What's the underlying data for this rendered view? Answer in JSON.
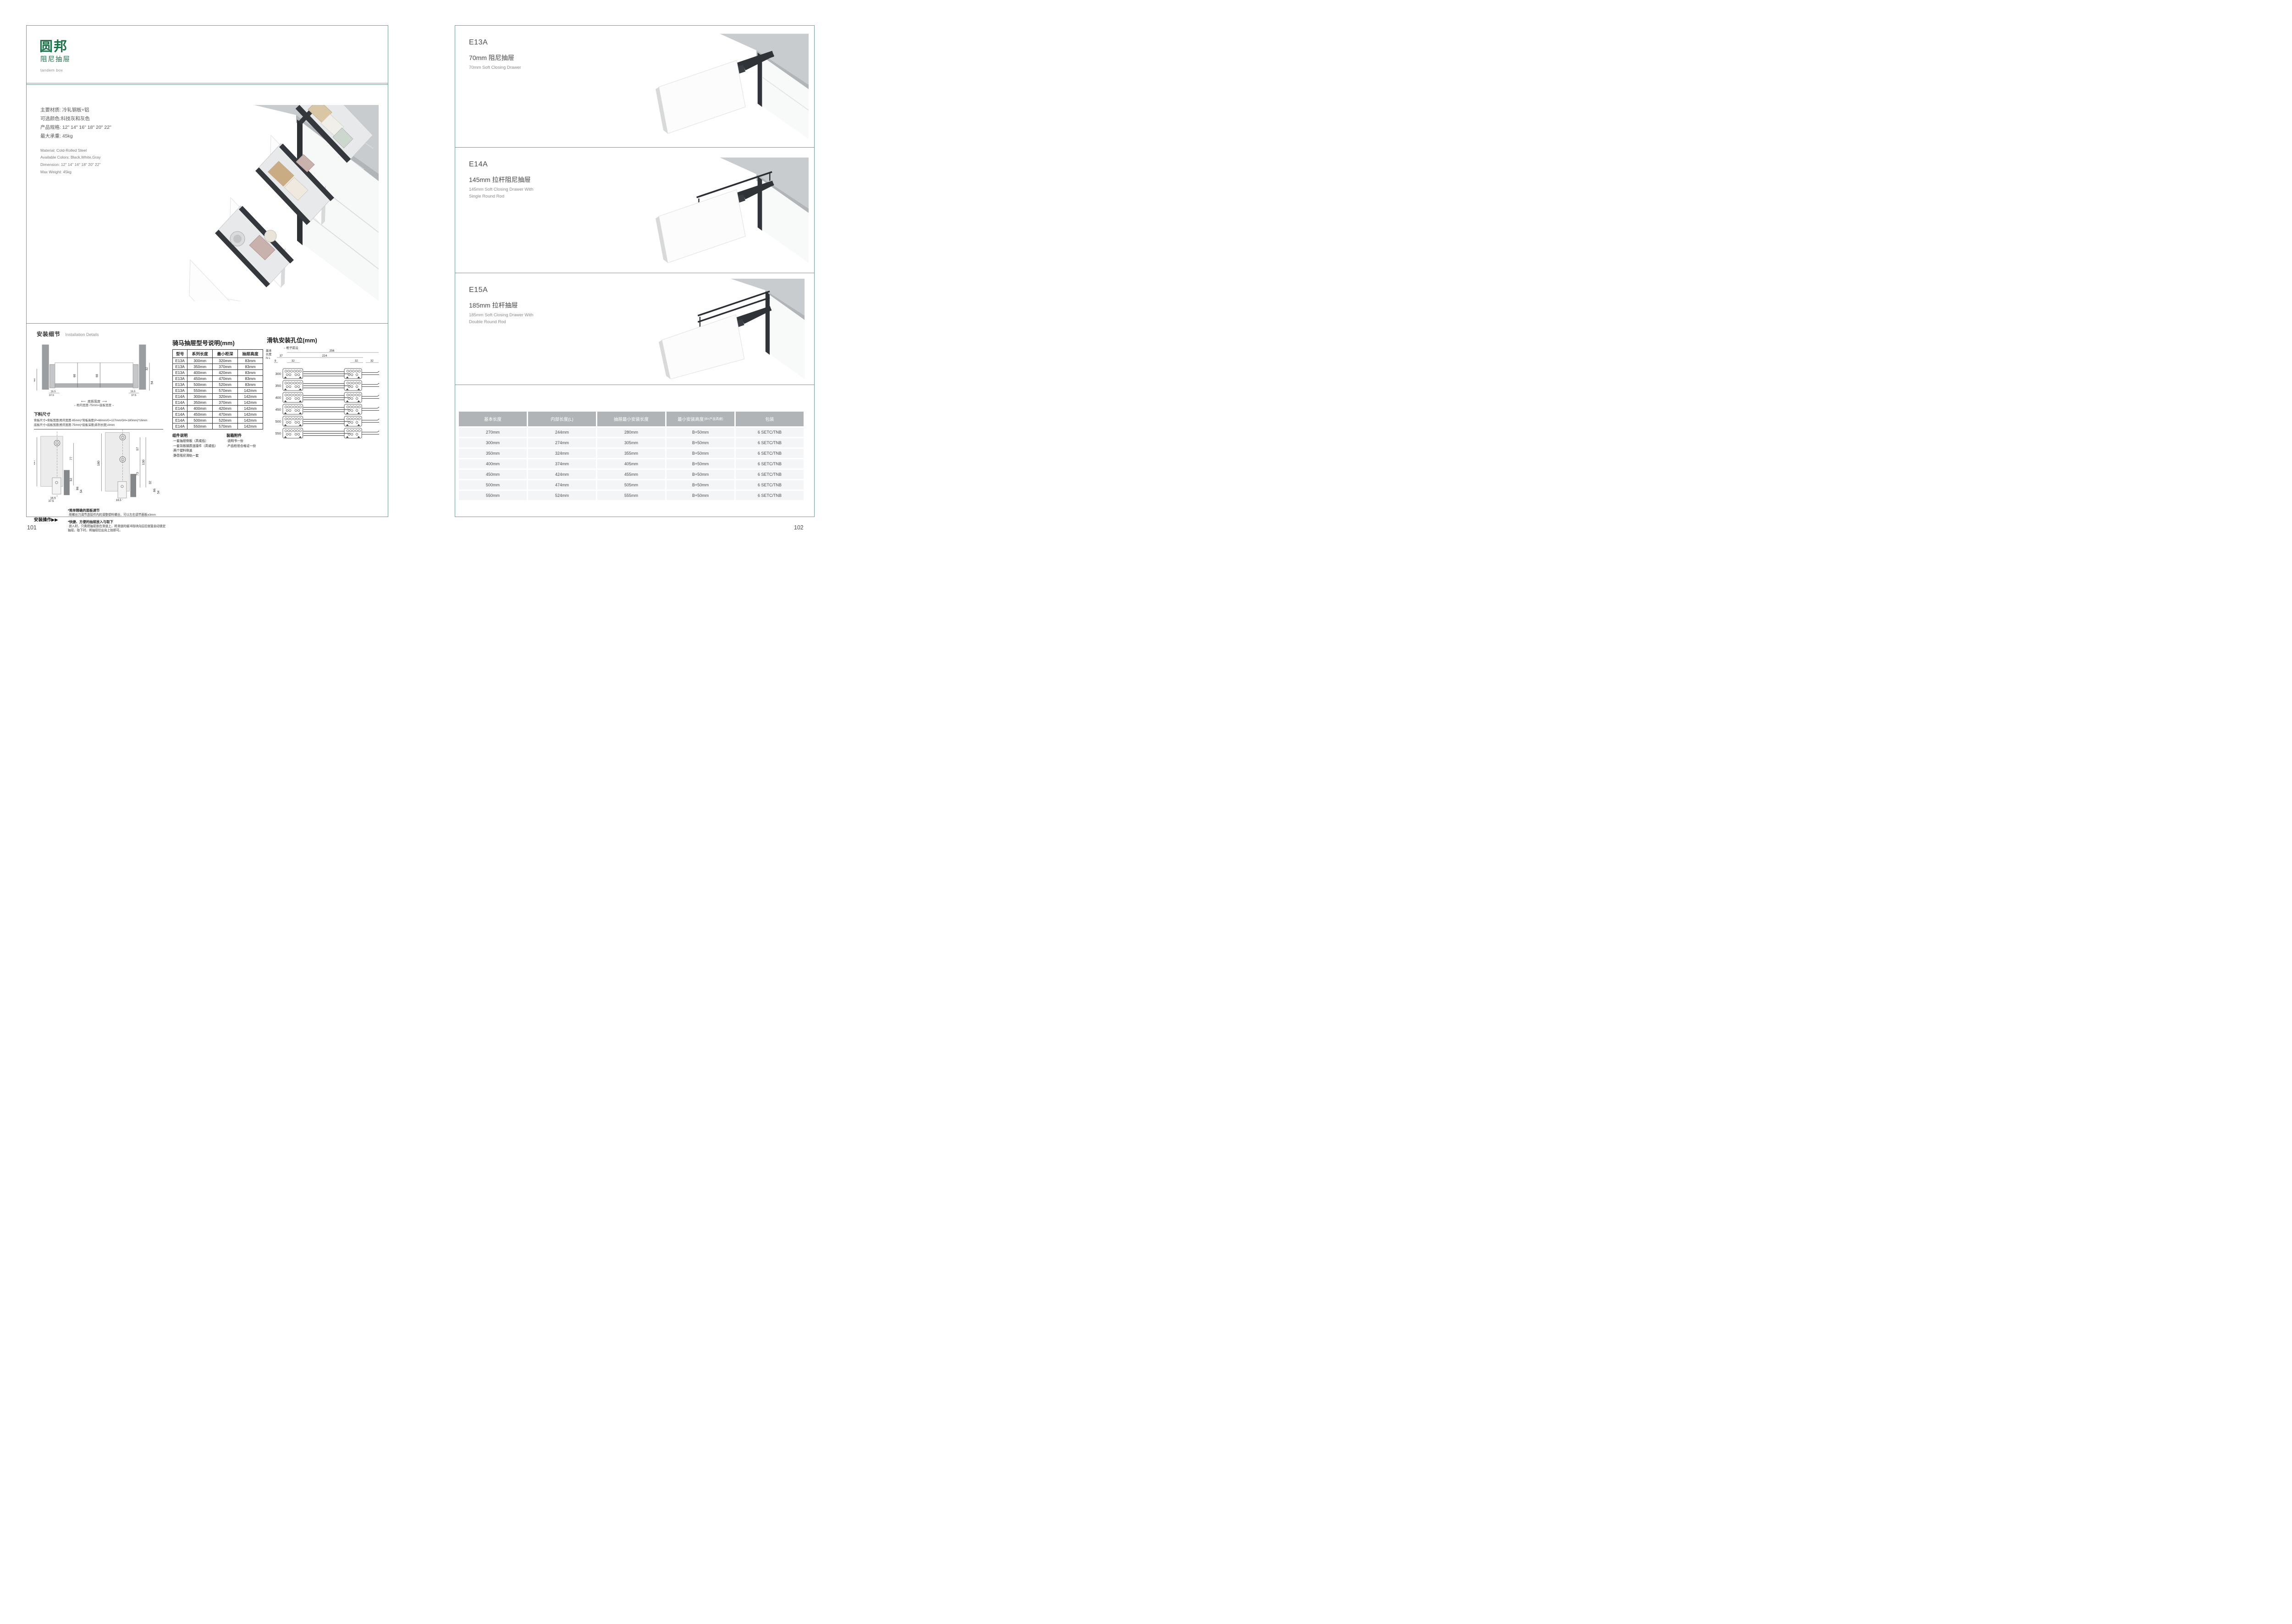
{
  "colors": {
    "accent_green": "#1d7149",
    "border_green": "#6e9a88",
    "table_header_gray": "#b1b4b6",
    "table_row_gray": "#f4f5f6",
    "drawer_dark": "#2f3237"
  },
  "left_page": {
    "brand": "圆邦",
    "brand_sub": "阻尼抽屉",
    "brand_en": "tandem box",
    "specs_cn": [
      "主要材质: 冷轧钢板+铝",
      "可选颜色:科技灰和灰色",
      "产品规格: 12\" 14\" 16\" 18\" 20\" 22\"",
      "最大承重: 45kg"
    ],
    "specs_en": [
      "Material: Cold-Rolled Steel",
      "Available Colors: Black,White,Gray",
      "Dimension: 12\" 14\" 16\" 18\" 20\" 22\"",
      "Max Weight: 45kg"
    ],
    "install": {
      "title_cn": "安装细节",
      "title_en": "Installation Details",
      "cross_section": {
        "dim_inner_l": "68",
        "dim_inner_r": "68",
        "dim_left": "46",
        "dim_right_top": "32",
        "dim_right_bottom": "54",
        "foot_inner_l": "16.5",
        "foot_outer_l": "37.5",
        "foot_inner_r": "16.5",
        "foot_outer_r": "37.5",
        "bottom_label": "底板宽度",
        "bottom_formula": "柜内宽度-75mm=底板宽度"
      },
      "cutting": {
        "title": "下料尺寸",
        "lines": [
          "背板尺寸=背板宽度(柜内宽度-85mm)*背板高度(P=68mm/G=127mm/GH=180mm)*16mm",
          "底板尺寸=底板宽度(柜内宽度-75mm)*底板深度(系列长度)-8mm"
        ]
      },
      "elev_left": {
        "h": "127",
        "a": "77",
        "b": "32",
        "c": "86",
        "d": "54",
        "f1": "16.5",
        "f2": "37.5"
      },
      "elev_right": {
        "h": "180",
        "a": "57",
        "b": "73",
        "c": "130",
        "d": "32",
        "e": "86",
        "f": "54",
        "f1": "16.5",
        "f2": "37.5"
      },
      "ops": {
        "label": "安装操作",
        "arrows": "▶▶",
        "notes": [
          {
            "head": "*简单精确的面板调节",
            "body": "·用螺丝刀调节连接件内的调整塑料螺丝，可以左右调节面板±3mm"
          },
          {
            "head": "*快捷、方便的抽屉放入与取下",
            "body": "·放入时，只需把抽屉放在滑道上，将滑道的缓冲挡块向后拉就能自动锁定抽屉。取下时，将抽屉拉出向上抬即可。"
          }
        ]
      }
    },
    "model_table": {
      "title": "骑马抽屉型号说明(mm)",
      "headers": [
        "型号",
        "系列长度",
        "最小柜深",
        "抽屉高度"
      ],
      "rows": [
        [
          "E13A",
          "300mm",
          "320mm",
          "83mm"
        ],
        [
          "E13A",
          "350mm",
          "370mm",
          "83mm"
        ],
        [
          "E13A",
          "400mm",
          "420mm",
          "83mm"
        ],
        [
          "E13A",
          "450mm",
          "470mm",
          "83mm"
        ],
        [
          "E13A",
          "500mm",
          "520mm",
          "83mm"
        ],
        [
          "E13A",
          "550mm",
          "570mm",
          "142mm"
        ],
        [
          "E14A",
          "300mm",
          "320mm",
          "142mm"
        ],
        [
          "E14A",
          "350mm",
          "370mm",
          "142mm"
        ],
        [
          "E14A",
          "400mm",
          "420mm",
          "142mm"
        ],
        [
          "E14A",
          "450mm",
          "470mm",
          "142mm"
        ],
        [
          "E14A",
          "500mm",
          "520mm",
          "142mm"
        ],
        [
          "E14A",
          "550mm",
          "570mm",
          "142mm"
        ]
      ]
    },
    "components": {
      "title": "组件说明",
      "items": [
        "·一套抽屉侧板（高或低）",
        "·一套背板钢质连接件（高或低）",
        "·两个塑料侧盖",
        "·静音阻尼滑轨一套"
      ]
    },
    "accessories": {
      "title": "装箱附件",
      "items": [
        "·说明书一份",
        "·产品检验合格证一份"
      ]
    },
    "slide_holes": {
      "title": "滑轨安装孔位(mm)",
      "axis_l1": "基本",
      "axis_l2": "长度",
      "axis_l3": "N L",
      "front_edge": "柜子前沿",
      "dims": {
        "total": "256",
        "inner": "224",
        "d37": "37",
        "d9": "9",
        "d32": "32"
      },
      "lengths": [
        "300",
        "350",
        "400",
        "450",
        "500",
        "550"
      ]
    },
    "page_number": "101"
  },
  "right_page": {
    "products": [
      {
        "code": "E13A",
        "title_cn": "70mm 阻尼抽屉",
        "title_en": "70mm Soft Closing Drawer",
        "title_en2": ""
      },
      {
        "code": "E14A",
        "title_cn": "145mm 拉杆阻尼抽屉",
        "title_en": "145mm Soft Closing Drawer With",
        "title_en2": "Single Round Rod"
      },
      {
        "code": "E15A",
        "title_cn": "185mm 拉杆抽屉",
        "title_en": "185mm Soft Closing Drawer With",
        "title_en2": "Double Round Rod"
      }
    ],
    "size_table": {
      "headers": [
        "基本长度",
        "内部长度(L)",
        "抽屉最小安装长度",
        "最小安装高度",
        "包装"
      ],
      "header4_small": "(B=产品高度)",
      "rows": [
        [
          "270mm",
          "244mm",
          "280mm",
          "B+50mm",
          "6 SETC/TNB"
        ],
        [
          "300mm",
          "274mm",
          "305mm",
          "B+50mm",
          "6 SETC/TNB"
        ],
        [
          "350mm",
          "324mm",
          "355mm",
          "B+50mm",
          "6 SETC/TNB"
        ],
        [
          "400mm",
          "374mm",
          "405mm",
          "B+50mm",
          "6 SETC/TNB"
        ],
        [
          "450mm",
          "424mm",
          "455mm",
          "B+50mm",
          "6 SETC/TNB"
        ],
        [
          "500mm",
          "474mm",
          "505mm",
          "B+50mm",
          "6 SETC/TNB"
        ],
        [
          "550mm",
          "524mm",
          "555mm",
          "B+50mm",
          "6 SETC/TNB"
        ]
      ]
    },
    "page_number": "102"
  }
}
